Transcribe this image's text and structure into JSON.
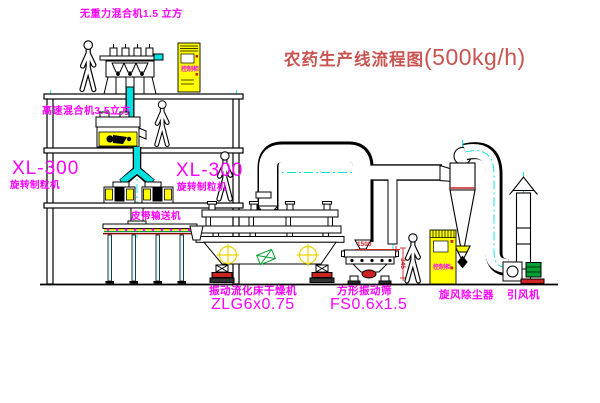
{
  "title": {
    "prefix": "农药生产线流程图",
    "capacity": "(500kg/h)"
  },
  "labels": {
    "top_mixer": "无重力混合机1.5 立方",
    "high_speed_mixer": "高速混合机3.5立方",
    "xl_left_model": "XL-300",
    "xl_left_name": "旋转制粒机",
    "xl_right_model": "XL-300",
    "xl_right_name": "旋转制粒机",
    "belt": "皮带输送机",
    "dryer_name": "振动流化床干燥机",
    "dryer_model": "ZLG6x0.75",
    "sieve_name": "方形振动筛",
    "sieve_model": "FS0.6x1.5",
    "cyclone": "旋风除尘器",
    "fan": "引风机",
    "cabinet_top": "控制柜",
    "cabinet_right": "控制柜",
    "dim_w": "1500",
    "dim_h": "345"
  },
  "colors": {
    "label_magenta": "#ff00ff",
    "title_red": "#c75450",
    "cad_yellow": "#ffff00",
    "centerline_cyan": "#00e0e0",
    "line_black": "#000000",
    "status_red": "#cc2222",
    "motor_green": "#00a033",
    "belt_darkred": "#8b0000"
  }
}
